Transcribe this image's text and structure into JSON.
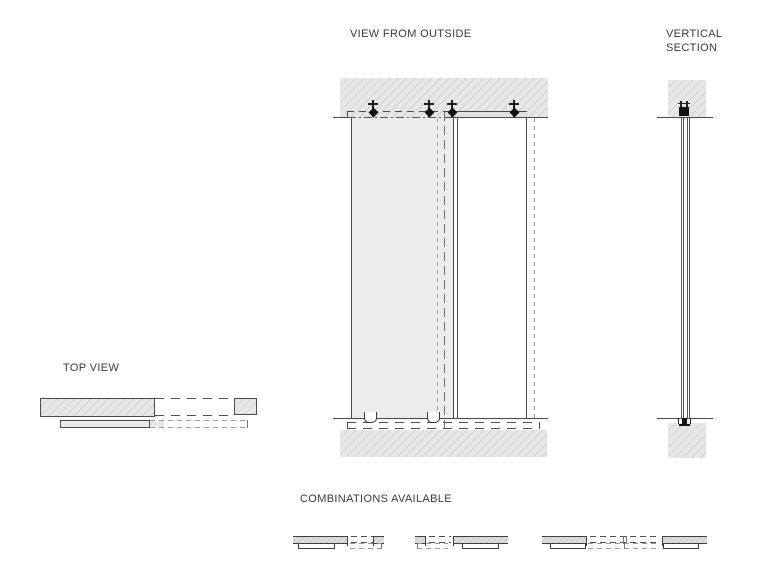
{
  "titles": {
    "view_from_outside": "VIEW FROM OUTSIDE",
    "vertical_section": "VERTICAL\nSECTION",
    "top_view": "TOP VIEW",
    "combinations_available": "COMBINATIONS AVAILABLE"
  },
  "colors": {
    "background": "#ffffff",
    "line_dark": "#4a4a4a",
    "line_hidden_gray": "#9a9a9a",
    "hatch_fill": "#e7e7e7",
    "hatch_line": "#d2d2d2",
    "sliding_panel_fill": "#ececec",
    "fixed_panel_fill": "#ffffff",
    "bracket_black": "#1d1d1d",
    "text": "#3a3a3a"
  },
  "icons": {
    "track_bracket": "T-stem with diamond clamp (ceiling track fixing)",
    "floor_guide": "U-shaped floor guide",
    "section_top_fixing": "black track fixing in section",
    "section_bottom_guide": "black floor guide in section"
  }
}
